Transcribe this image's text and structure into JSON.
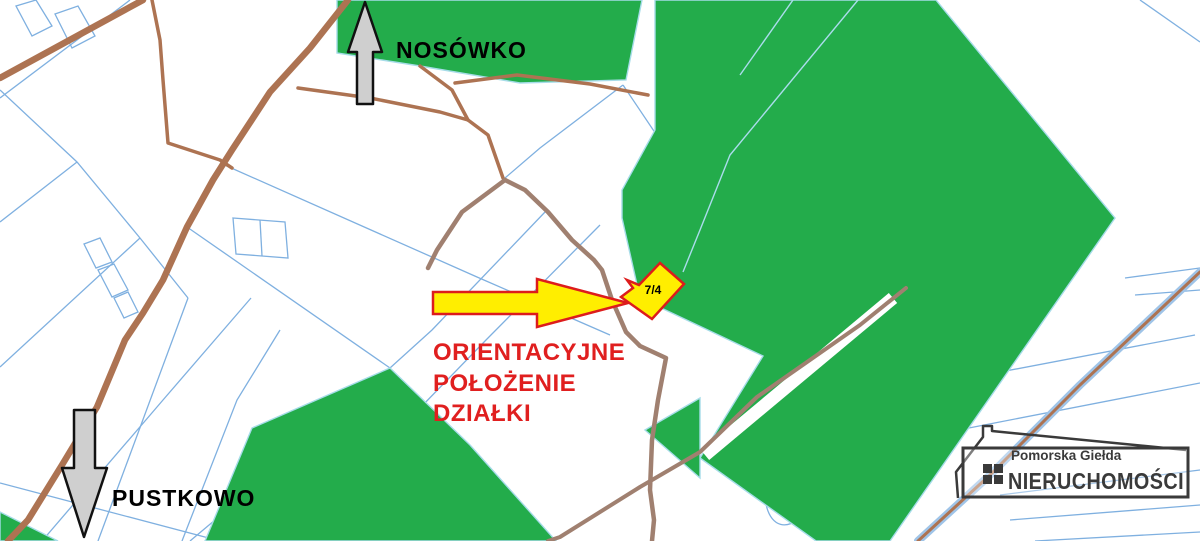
{
  "map": {
    "labels": {
      "north_village": "NOSÓWKO",
      "south_village": "PUSTKOWO",
      "parcel_number": "7/4"
    },
    "annotation": {
      "line1": "ORIENTACYJNE",
      "line2": "POŁOŻENIE",
      "line3": "DZIAŁKI"
    },
    "logo": {
      "subtitle": "Pomorska Giełda",
      "title": "NIERUCHOMOŚCI"
    },
    "icons": {
      "north": "arrow-up-icon",
      "south": "arrow-down-icon",
      "pointer": "arrow-right-icon",
      "logo_house": "house-icon",
      "logo_window": "window-icon"
    },
    "colors": {
      "background": "#ffffff",
      "parcel_line": "#7fb0e0",
      "forest": "#23ac4b",
      "forest_border": "#a6dce8",
      "forest_inner_line": "#aadcec",
      "road_major": "#ad7352",
      "road_minor": "#a08070",
      "road_edge": "#9fc4e8",
      "highlight_fill": "#ffee00",
      "highlight_stroke": "#dd1c1c",
      "annotation_red": "#e01f1f",
      "arrow_gray": "#cfcfcf",
      "arrow_outline": "#111111",
      "logo_dark": "#3a3a3a",
      "white": "#ffffff"
    }
  }
}
